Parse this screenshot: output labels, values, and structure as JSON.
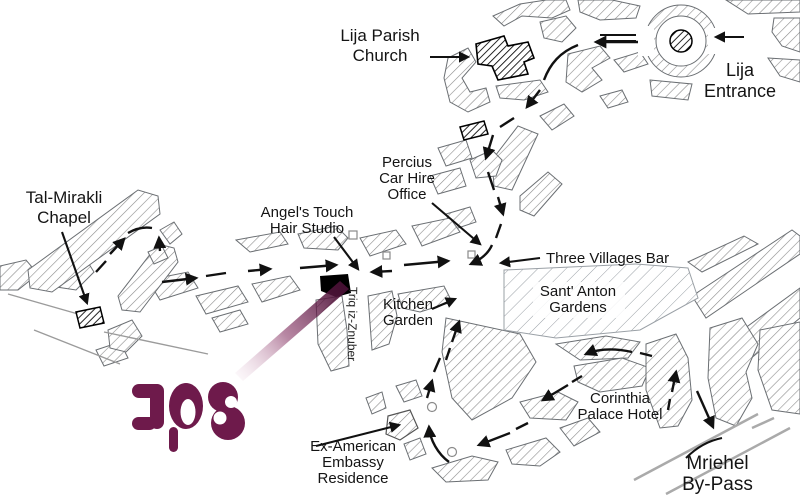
{
  "labels": {
    "church": {
      "l1": "Lija Parish",
      "l2": "Church"
    },
    "entrance": {
      "l1": "Lija",
      "l2": "Entrance"
    },
    "chapel": {
      "l1": "Tal-Mirakli",
      "l2": "Chapel"
    },
    "studio": {
      "l1": "Angel's Touch",
      "l2": "Hair Studio"
    },
    "car_hire": {
      "l1": "Percius",
      "l2": "Car Hire",
      "l3": "Office"
    },
    "bar": {
      "l1": "Three Villages Bar"
    },
    "gardens": {
      "l1": "Sant' Anton",
      "l2": "Gardens"
    },
    "kitchen": {
      "l1": "Kitchen",
      "l2": "Garden"
    },
    "embassy": {
      "l1": "Ex-American",
      "l2": "Embassy",
      "l3": "Residence"
    },
    "hotel": {
      "l1": "Corinthia",
      "l2": "Palace Hotel"
    },
    "bypass": {
      "l1": "Mriehel",
      "l2": "By-Pass"
    },
    "street": "Triq iz-Znuber",
    "logo_text": "JOS"
  },
  "colors": {
    "logo_maroon": "#6E1A4B",
    "beam_dark": "#471034",
    "route_line": "#111111",
    "hatch_gray": "#8c8c8c",
    "light_hatch_gray": "#9aa0a6",
    "bypass_gray": "#aaaaaa"
  }
}
